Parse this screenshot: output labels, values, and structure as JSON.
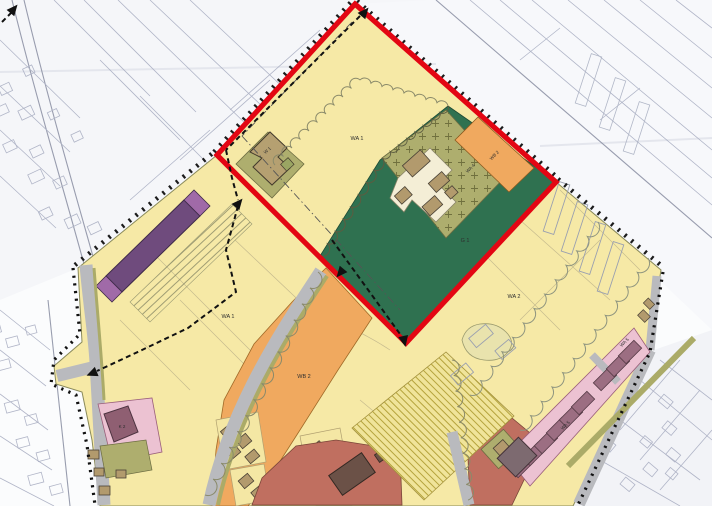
{
  "plan": {
    "labels": {
      "wa1_red": "WA 1",
      "w1_building": "W 1",
      "wa4_orchard": "WA 4",
      "g1_green": "G 1",
      "wb2_parcel": "WB 2",
      "wa1_main": "WA 1",
      "wa2_east": "WA 2",
      "wb2_main": "WB 2",
      "wa5_south": "WA 5",
      "wa5_north": "WA 5",
      "k2_building": "K 2"
    },
    "colors": {
      "boundary_red": "#e30613",
      "zone_yellow": "#f6e9a6",
      "zone_orange": "#f0a95f",
      "zone_green": "#2f7150",
      "zone_olive": "#aeae6e",
      "zone_purple": "#6f4b7d",
      "zone_pink": "#ecc2d2",
      "zone_terracotta": "#c06f60",
      "road_gray": "#b9babe",
      "building_tan": "#b29a6d",
      "building_mauve": "#9c6e82"
    }
  }
}
